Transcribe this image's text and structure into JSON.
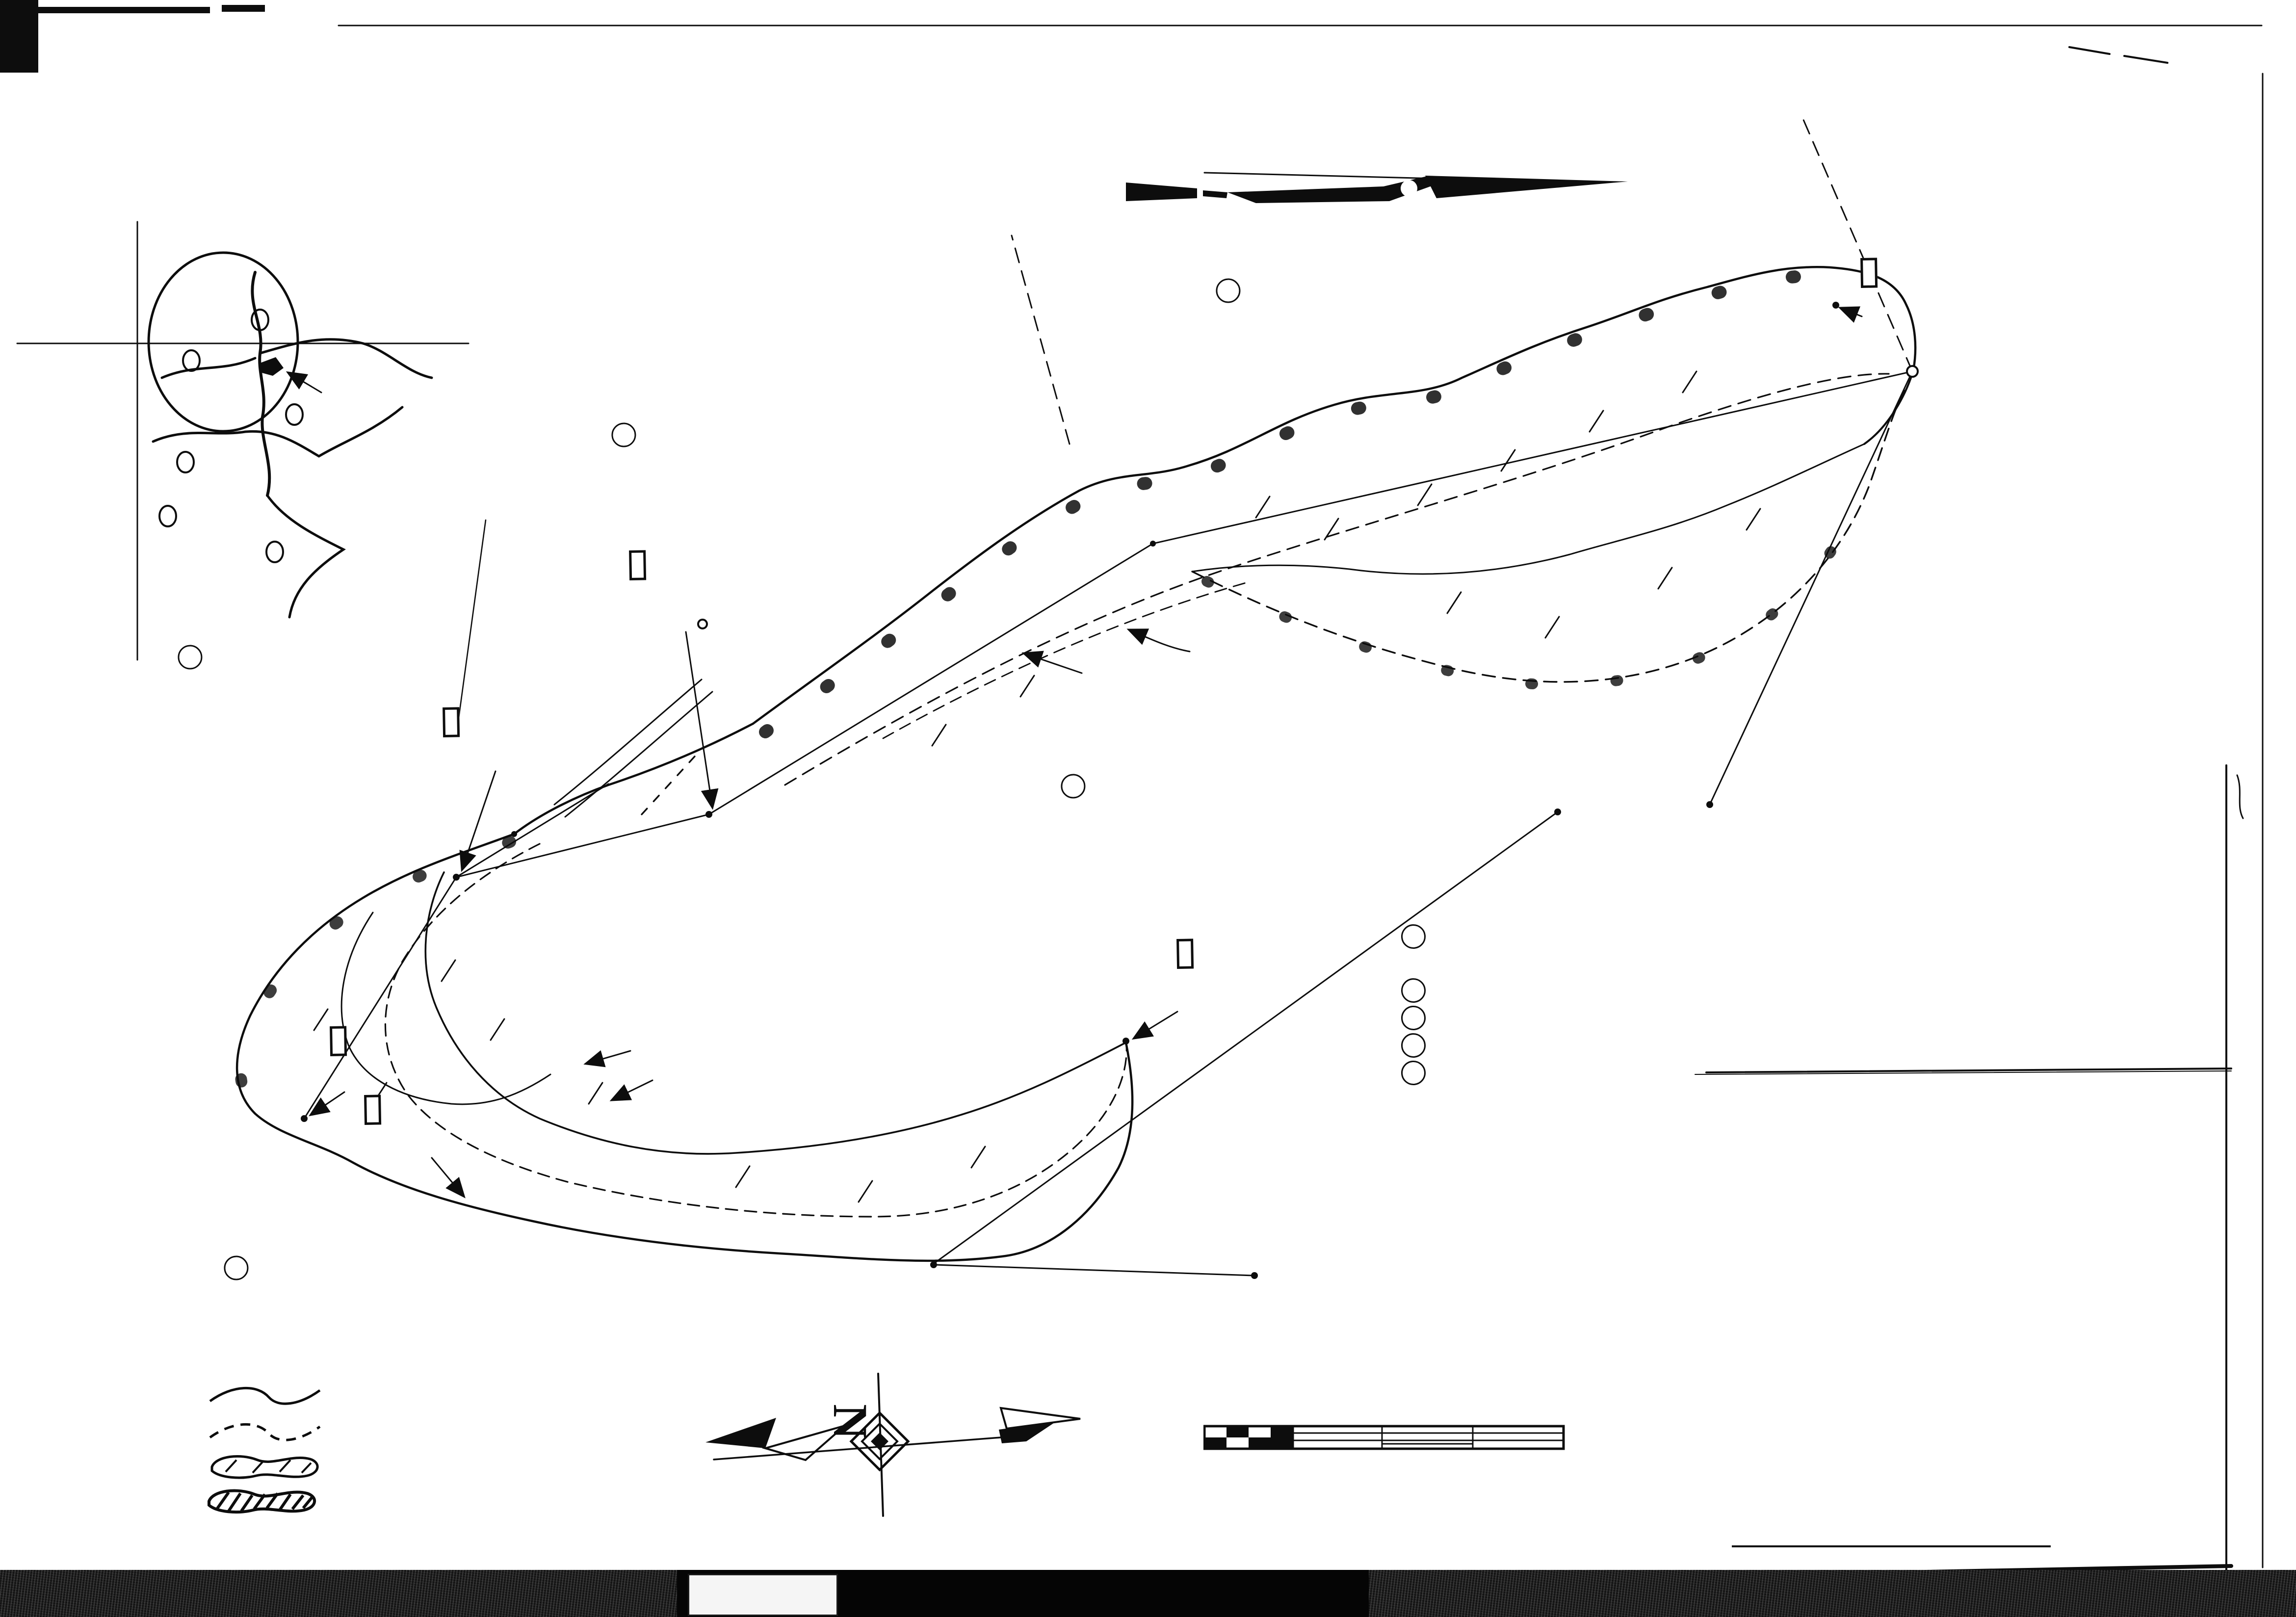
{
  "sheet": {
    "magnetic_north_label": "MAGNETIC NORTH 1965",
    "inset": {
      "long_label": "LONG. W.",
      "long_value": "80°00'",
      "lat_label": "LAT. N.",
      "lat_value": "39°40'",
      "caption_line1": "LOCATION OF",
      "caption_line2": "SURFACE MINE"
    },
    "tracts": {
      "A": {
        "key": "A",
        "name": "GEORGE JOHNSON - COAL & SURFACE"
      },
      "B": {
        "key": "B",
        "name": "RAINEY DAWSON - SURFACE"
      },
      "C": {
        "key": "C",
        "name": "RAYMOND FETSCO - SURFACE"
      },
      "D": {
        "key": "D",
        "name": "PASCAL MAYFIELD - SURFACE"
      },
      "E": {
        "key": "E",
        "name": "CHANCEY LAWYMEN - SURFACE"
      }
    },
    "neighbor": "JOHN McKINNEY",
    "markers": {
      "iron_pipe": "IRON PIPE",
      "iron_pin": "IRON PIN",
      "red_oak": "26\" RED OAK",
      "three_inch_pipe": "3\" IRON PIPE",
      "end_of_strip_1": "END OF STRIP",
      "end_of_strip_2": "MARKER",
      "permanent_1": "PERMANENT",
      "permanent_2": "MARKER"
    },
    "features": {
      "spoil": "SPOIL",
      "area": "AREA",
      "base": "BASE",
      "line": "LINE",
      "production": "PRODUCTION",
      "old_mine_openings": "OLD MINE OPENINGS",
      "pre_existing_mine_road": "PRE-EXISTING MINE ROAD",
      "outline_disturbed_area": "OUTLINE DISTURBED AREA",
      "base_of_highwall": "BASE OF HIGHWALL"
    },
    "property_lines": {
      "label": "PROPERTY LINE",
      "n2130": "N 21°30' W",
      "n6630": "N 66°30' W",
      "n1050": "N 10°50' W",
      "n3050": "N 30°50' E"
    }
  },
  "areas_table": {
    "title": "AREAS",
    "owners_header": "OWNERS",
    "headers": {
      "c1": {
        "l1": "TOTAL",
        "l2": "DISTURBED",
        "l3": "AREA"
      },
      "c2": {
        "l1": "TOTAL",
        "l2": "PRODUCTION",
        "l3": "AREA"
      },
      "c3": {
        "l1": "AFFECTED",
        "l2": "AREA"
      },
      "c4": {
        "l1": "REGRADED",
        "l2": "AREA"
      },
      "c5": {
        "l1": "RECLAIMED",
        "l2": "AREA"
      }
    },
    "rows": [
      {
        "key": "A",
        "owner": "GEORGE JOHNSON - COAL",
        "owner2": "& SURFACE",
        "v": [
          "10.41",
          "1.73",
          "6.13",
          "10.41",
          "0.00"
        ]
      },
      {
        "key": "B",
        "owner": "RAINEY DAWSON - SURFACE",
        "owner2": "",
        "v": [
          "0.34",
          "0.00",
          "0.10",
          "0.34",
          "0.00"
        ]
      },
      {
        "key": "C",
        "owner": "RAYMOND FETSCO - SURFACE",
        "owner2": "",
        "v": [
          "0.44",
          "0.00",
          "0.44",
          "0.44",
          "0.00"
        ]
      },
      {
        "key": "D",
        "owner": "PASCAL MAYFIELD - SURFACE",
        "owner2": "",
        "v": [
          "0.03",
          "0.00",
          "0.03",
          "0.03",
          "0.00"
        ]
      },
      {
        "key": "E",
        "owner": "CHANCEY LAWYMEN - SURFACE",
        "owner2": "",
        "v": [
          "1.18",
          "0.00",
          "1.18",
          "1.18",
          "0.00"
        ]
      }
    ],
    "totals_label": "TOTALS",
    "totals": [
      "12.40 AC.",
      "1.73 AC.",
      "7.88 AC.",
      "12.40 AC",
      "0.00 AC."
    ],
    "seam_label": "SEAM OF COAL",
    "seam_dots": ".  .  .  .  .  .  .  .",
    "seam_value": "WAYNESBURG",
    "lineal_label": "LINEAL FEET OF HIGHWALL",
    "lineal_dots": ".  .  .  .",
    "lineal_value": "2560 LF"
  },
  "notes": {
    "line1": "Aug 6- 1965",
    "line2": "Richard Quisenberry. R. Inspt.",
    "line3": "Dept. Natural Resources.",
    "line4": "Andrew Casto Dept miner Inspt"
  },
  "legend": {
    "title": "LEGEND",
    "items": [
      {
        "label": "DISTURBED AREA"
      },
      {
        "label": "AFFECTED AREA"
      },
      {
        "label": "REGRADED AREA"
      },
      {
        "label": "RECLAIMED AREA"
      }
    ]
  },
  "scale_bar": {
    "ticks": [
      "100",
      "0",
      "100",
      "200",
      "300"
    ],
    "caption": "Scale, feet"
  },
  "title_block": {
    "line1": "COMPLETION MAP FOR SURFACE MINING",
    "line2": "PERMIT NO. S 5608",
    "line3": "& S 5608-2",
    "line4": "BY",
    "company1": "PONTORERO & SONS",
    "company2": "COAL CO., INC.",
    "city": "MASONTOWN, PA.",
    "in_word": "IN",
    "county_left": "MONONGALIA CO.",
    "county_right": "CASS DIST.",
    "state": "WEST VIRGINIA",
    "scale_label": "SCALE: 1\" = 100'",
    "date": "23 JULY 1965",
    "signed_label": "SIGNED:",
    "signature": "Floyd M Stiles",
    "surveyor": "FLOYD R. STILES   COUNTY SURVEYOR",
    "surveyor2": "PRESTON COUNTY"
  },
  "film_strip": {
    "l1": "C",
    "l2": "B",
    "l3": "A",
    "code": "WVDM",
    "reel": "17X",
    "number": "370 077",
    "r1": "A",
    "r2": "B",
    "r3": "C"
  }
}
